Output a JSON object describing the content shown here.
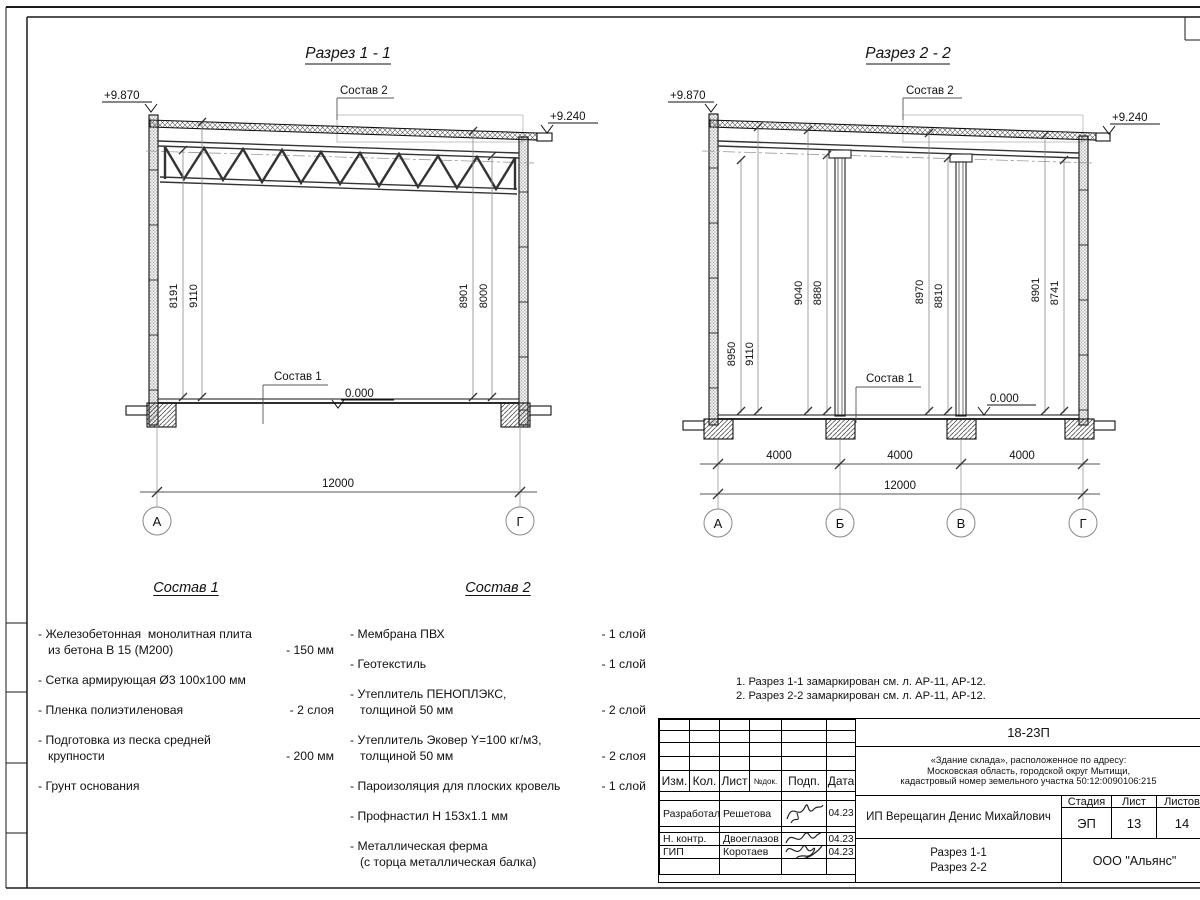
{
  "section1": {
    "title": "Разрез 1 - 1",
    "elev_left": "+9.870",
    "elev_right": "+9.240",
    "elev_floor": "0.000",
    "callout_roof": "Состав 2",
    "callout_floor": "Состав 1",
    "dim_v": [
      "8191",
      "9110",
      "8901",
      "8000"
    ],
    "dim_span": "12000",
    "axes": [
      "А",
      "Г"
    ]
  },
  "section2": {
    "title": "Разрез 2 - 2",
    "elev_left": "+9.870",
    "elev_right": "+9.240",
    "elev_floor": "0.000",
    "callout_roof": "Состав 2",
    "callout_floor": "Состав 1",
    "dim_v": [
      "8950",
      "9110",
      "9040",
      "8880",
      "8970",
      "8810",
      "8901",
      "8741"
    ],
    "dim_bays": [
      "4000",
      "4000",
      "4000"
    ],
    "dim_span": "12000",
    "axes": [
      "А",
      "Б",
      "В",
      "Г"
    ]
  },
  "compositions": {
    "comp1": {
      "title": "Состав 1",
      "items": [
        {
          "lines": [
            "- Железобетонная  монолитная плита",
            "из бетона В 15 (М200)"
          ],
          "value": "- 150 мм"
        },
        {
          "lines": [
            "- Сетка армирующая Ø3 100х100 мм"
          ],
          "value": ""
        },
        {
          "lines": [
            "- Пленка полиэтиленовая"
          ],
          "value": "-  2 слоя"
        },
        {
          "lines": [
            "- Подготовка из песка средней",
            "крупности"
          ],
          "value": "- 200 мм"
        },
        {
          "lines": [
            "- Грунт основания"
          ],
          "value": ""
        }
      ]
    },
    "comp2": {
      "title": "Состав 2",
      "items": [
        {
          "lines": [
            "- Мембрана ПВХ"
          ],
          "value": "- 1 слой"
        },
        {
          "lines": [
            "- Геотекстиль"
          ],
          "value": "- 1 слой"
        },
        {
          "lines": [
            "- Утеплитель ПЕНОПЛЭКС,",
            "толщиной 50 мм"
          ],
          "value": "- 2 слой"
        },
        {
          "lines": [
            "- Утеплитель Эковер Y=100 кг/м3,",
            "толщиной 50 мм"
          ],
          "value": "- 2 слоя"
        },
        {
          "lines": [
            "- Пароизоляция для плоских кровель"
          ],
          "value": "- 1 слой"
        },
        {
          "lines": [
            "- Профнастил Н 153х1.1 мм"
          ],
          "value": ""
        },
        {
          "lines": [
            "- Металлическая ферма",
            "(с торца металлическая балка)"
          ],
          "value": ""
        }
      ]
    }
  },
  "notes": [
    "1. Разрез 1-1 замаркирован см. л. АР-11, АР-12.",
    "2. Разрез 2-2 замаркирован см. л. АР-11, АР-12."
  ],
  "titleblock": {
    "code": "18-23П",
    "address": [
      "«Здание склада», расположенное по адресу:",
      "Московская область, городской округ Мытищи,",
      "кадастровый номер земельного участка 50:12:0090106:215"
    ],
    "cols": {
      "izm": "Изм.",
      "kol": "Кол.",
      "list": "Лист",
      "ndok": "№док.",
      "podp": "Подп.",
      "data": "Дата"
    },
    "rows": [
      {
        "role": "Разработал",
        "name": "Решетова",
        "date": "04.23"
      },
      {
        "role": "Н. контр.",
        "name": "Двоеглазов",
        "date": "04.23"
      },
      {
        "role": "ГИП",
        "name": "Коротаев",
        "date": "04.23"
      }
    ],
    "client": "ИП Верещагин Денис Михайлович",
    "stage_label": "Стадия",
    "sheet_label": "Лист",
    "sheets_label": "Листов",
    "stage": "ЭП",
    "sheet": "13",
    "sheets": "14",
    "drawing": [
      "Разрез 1-1",
      "Разрез 2-2"
    ],
    "company": "ООО \"Альянс\""
  }
}
